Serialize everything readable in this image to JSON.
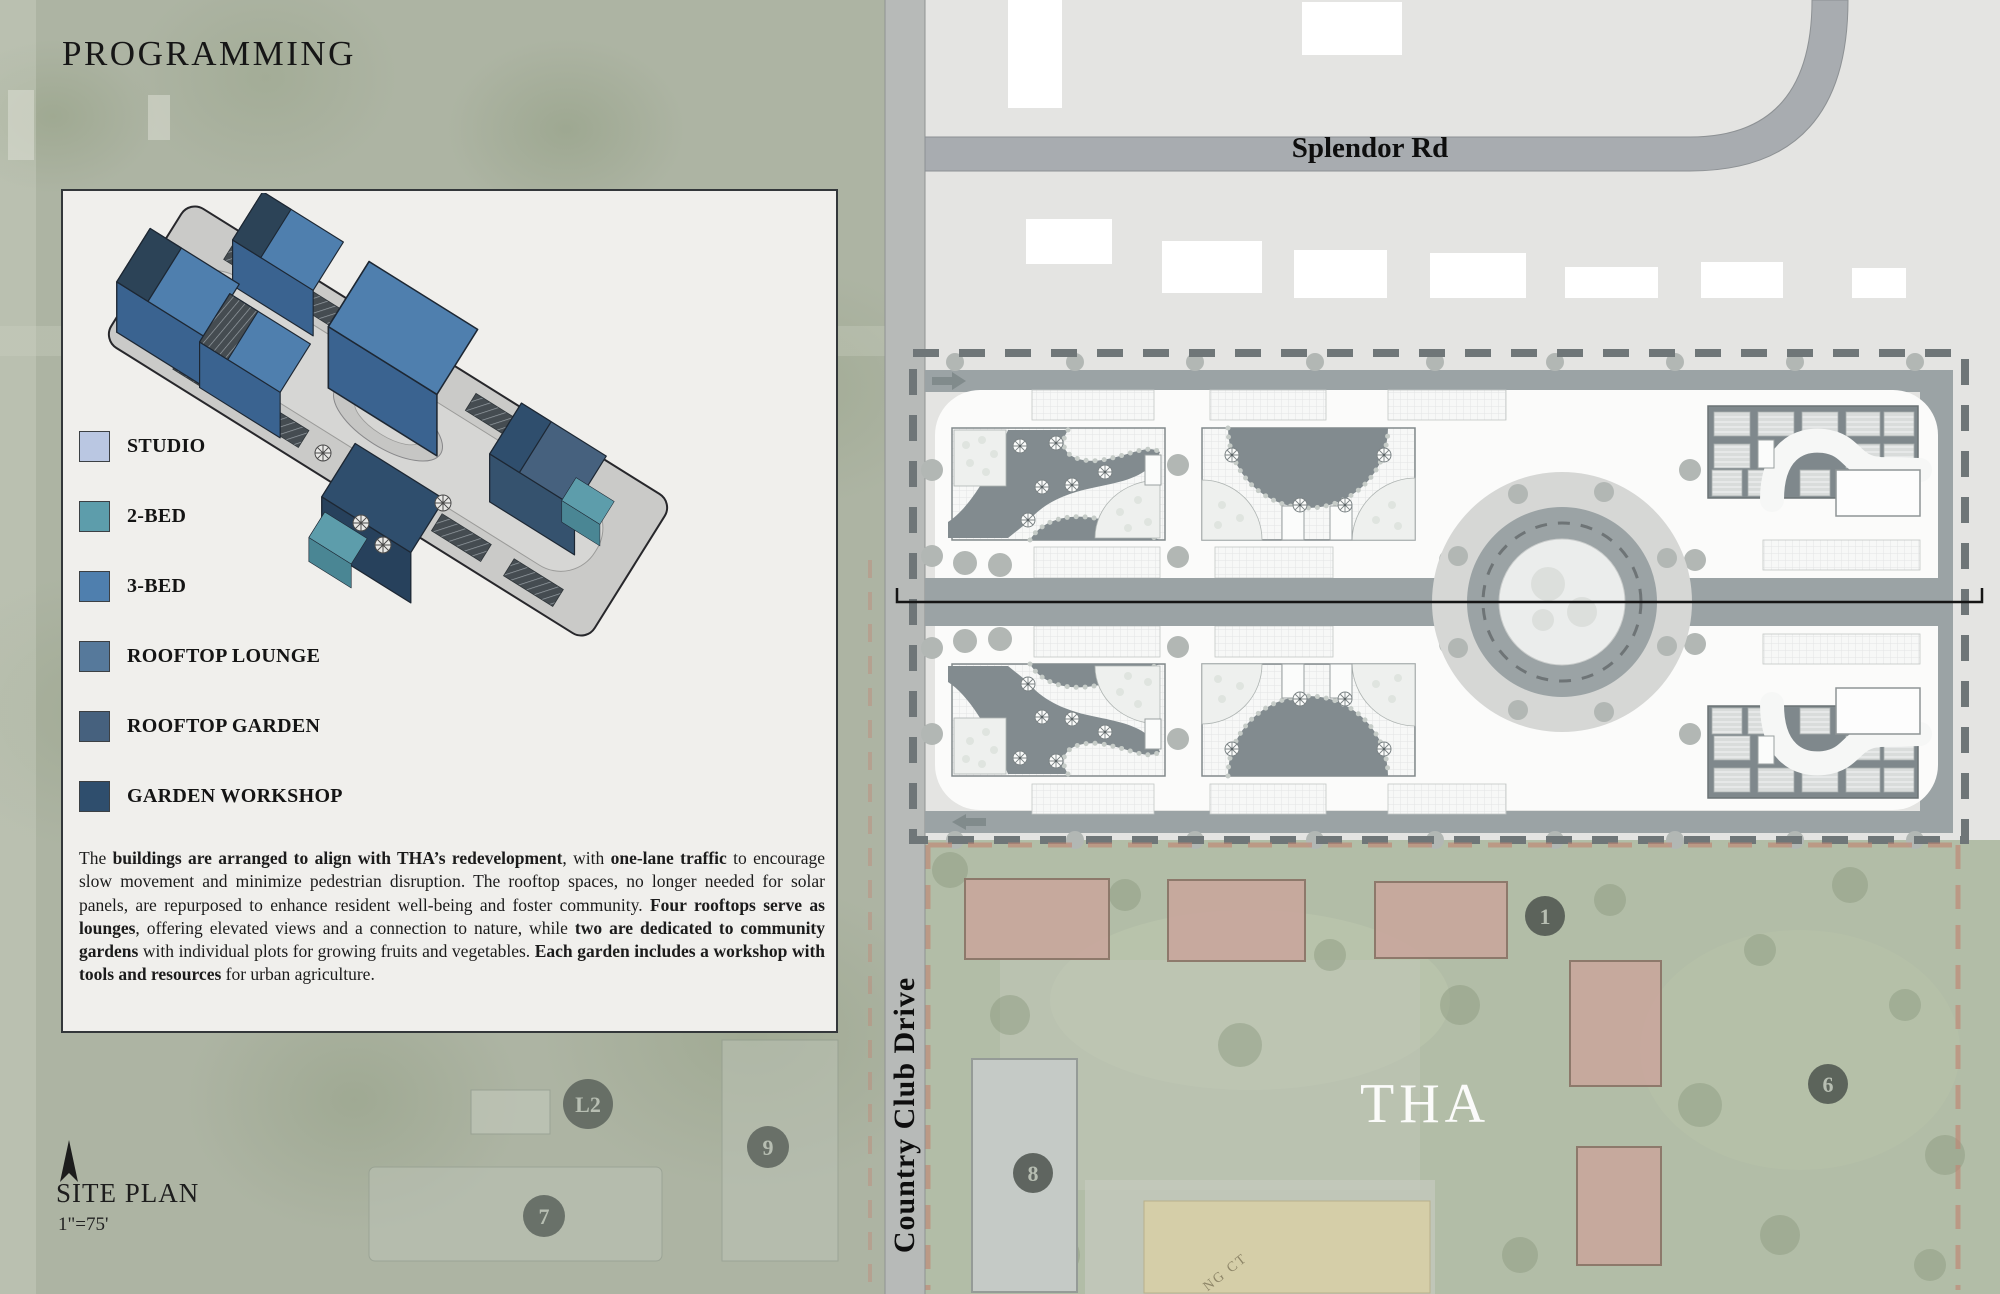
{
  "title": "PROGRAMMING",
  "panel": {
    "legend": {
      "items": [
        {
          "label": "STUDIO",
          "color": "#bac7e2"
        },
        {
          "label": "2-BED",
          "color": "#5d9dab"
        },
        {
          "label": "3-BED",
          "color": "#4f7fae"
        },
        {
          "label": "ROOFTOP LOUNGE",
          "color": "#56799b"
        },
        {
          "label": "ROOFTOP GARDEN",
          "color": "#46617e"
        },
        {
          "label": "GARDEN WORKSHOP",
          "color": "#2f4e6d"
        }
      ]
    },
    "description_segments": [
      {
        "text": "The ",
        "bold": false
      },
      {
        "text": "buildings are arranged to align with THA’s redevelopment",
        "bold": true
      },
      {
        "text": ", with ",
        "bold": false
      },
      {
        "text": "one-lane traffic",
        "bold": true
      },
      {
        "text": " to encourage slow movement and minimize pedestrian disruption. The rooftop spaces, no longer needed for solar panels, are repurposed to enhance resident well-being and foster community. ",
        "bold": false
      },
      {
        "text": "Four rooftops serve as lounges",
        "bold": true
      },
      {
        "text": ", offering elevated views and a connection to nature, while ",
        "bold": false
      },
      {
        "text": "two are dedicated to community gardens",
        "bold": true
      },
      {
        "text": " with individual plots for growing fruits and vegetables. ",
        "bold": false
      },
      {
        "text": "Each garden includes a workshop with tools and resources",
        "bold": true
      },
      {
        "text": " for urban agriculture.",
        "bold": false
      }
    ]
  },
  "site_plan": {
    "label": "SITE PLAN",
    "scale": "1\"=75'"
  },
  "map": {
    "road_labels": {
      "splendor": "Splendor Rd",
      "country_club": "Country Club Drive"
    },
    "area_label": "THA",
    "court_label": "NG CT",
    "badges": [
      {
        "label": "L2"
      },
      {
        "label": "9"
      },
      {
        "label": "7"
      },
      {
        "label": "1"
      },
      {
        "label": "8"
      },
      {
        "label": "6"
      }
    ],
    "colors": {
      "left_background": "#adb4a3",
      "parcel_background": "#e4e4e2",
      "tha_green": "#b2bda7",
      "road": "#9ba3a5",
      "white_strip": "#fbfbfa",
      "roof_dark": "#828b8f",
      "boundary_dash": "#6f7678",
      "tha_boundary_dash": "#c08573"
    }
  }
}
